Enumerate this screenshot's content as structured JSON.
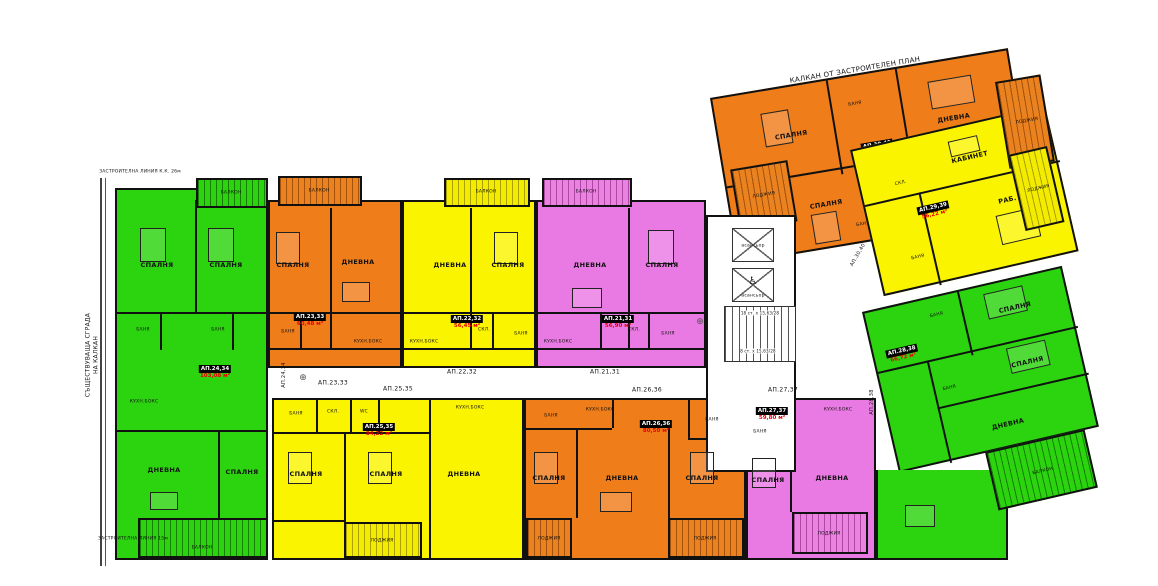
{
  "annotations": {
    "top_boundary": "КАЛКАН ОТ ЗАСТРОИТЕЛЕН ПЛАН",
    "left_boundary_line1": "СЪЩЕСТВУВАЩА СГРАДА",
    "left_boundary_line2": "НА КАЛКАН",
    "top_left_note": "ЗАСТРОИТЕЛНА ЛИНИЯ К.К. 26м",
    "bottom_left_note": "ЗАСТРОИТЕЛНА ЛИНИЯ 15м",
    "axis_mark": "⊕"
  },
  "core": {
    "elevator1": "асансьор",
    "elevator2": "асансьор",
    "wheelchair_icon": "♿",
    "stairs_upper": "18 ст. х 15,63/28",
    "stairs_lower": "8 ст. х 15,63/28"
  },
  "colors": {
    "green": "#2bd40e",
    "orange": "#ef7d1a",
    "yellow": "#fbf400",
    "magenta": "#ea7ae3",
    "area_text": "#e80000"
  },
  "apartments": {
    "ap2131": {
      "id": "АП.21,31",
      "area": "56,90 м²",
      "rooms": {
        "balkon": "БАЛКОН",
        "dnevna": "ДНЕВНА",
        "spalnya": "СПАЛНЯ",
        "banya": "БАНЯ",
        "skl": "СКЛ.",
        "kuhn": "КУХН.БОКС"
      }
    },
    "ap2232": {
      "id": "АП.22,32",
      "area": "56,45 м²",
      "rooms": {
        "balkon": "БАЛКОН",
        "dnevna": "ДНЕВНА",
        "spalnya": "СПАЛНЯ",
        "banya": "БАНЯ",
        "skl": "СКЛ.",
        "kuhn": "КУХН.БОКС"
      }
    },
    "ap2333": {
      "id": "АП.23,33",
      "area": "60,48 м²",
      "rooms": {
        "balkon": "БАЛКОН",
        "spalnya": "СПАЛНЯ",
        "dnevna": "ДНЕВНА",
        "banya": "БАНЯ",
        "kuhn": "КУХН.БОКС"
      }
    },
    "ap2434": {
      "id": "АП.24,34",
      "area": "103,08 м²",
      "rooms": {
        "balkon_top": "БАЛКОН",
        "spalnya1": "СПАЛНЯ",
        "spalnya2": "СПАЛНЯ",
        "banya1": "БАНЯ",
        "banya2": "БАНЯ",
        "kuhn": "КУХН.БОКС",
        "dnevna": "ДНЕВНА",
        "spalnya3": "СПАЛНЯ",
        "balkon_bottom": "БАЛКОН"
      }
    },
    "ap2535": {
      "id": "АП.25,35",
      "area": "84,22 м²",
      "rooms": {
        "banya": "БАНЯ",
        "skl": "СКЛ.",
        "wc": "WC",
        "kuhn": "КУХН.БОКС",
        "spalnya1": "СПАЛНЯ",
        "spalnya2": "СПАЛНЯ",
        "dnevna": "ДНЕВНА",
        "lodzhiya": "ЛОДЖИЯ"
      }
    },
    "ap2636": {
      "id": "АП.26,36",
      "area": "80,50 м²",
      "rooms": {
        "banya1": "БАНЯ",
        "banya2": "БАНЯ",
        "kuhn": "КУХН.БОКС",
        "spalnya1": "СПАЛНЯ",
        "dnevna": "ДНЕВНА",
        "spalnya2": "СПАЛНЯ",
        "lodzhiya1": "ЛОДЖИЯ",
        "lodzhiya2": "ЛОДЖИЯ"
      }
    },
    "ap2737": {
      "id": "АП.27,37",
      "area": "59,80 м²",
      "rooms": {
        "banya": "БАНЯ",
        "kuhn": "КУХН.БОКС",
        "spalnya": "СПАЛНЯ",
        "dnevna": "ДНЕВНА",
        "lodzhiya": "ЛОДЖИЯ"
      }
    },
    "ap2838": {
      "id": "АП.28,38",
      "area": "66,72 м²",
      "rooms": {
        "banya1": "БАНЯ",
        "spalnya1": "СПАЛНЯ",
        "banya2": "БАНЯ",
        "spalnya2": "СПАЛНЯ",
        "dnevna": "ДНЕВНА",
        "balkon": "БАЛКОН"
      }
    },
    "ap2939": {
      "id": "АП.29,39",
      "area": "56,22 м²",
      "rooms": {
        "kabinet": "КАБИНЕТ",
        "rab_pom": "РАБ. ПОМ.",
        "banya": "БАНЯ",
        "skl": "СКЛ.",
        "lodzhiya": "ЛОДЖИЯ"
      }
    },
    "ap3040": {
      "id": "АП.30,40",
      "area": "92,94 м²",
      "rooms": {
        "spalnya1": "СПАЛНЯ",
        "banya1": "БАНЯ",
        "dnevna": "ДНЕВНА",
        "lodzhiya1": "ЛОДЖИЯ",
        "spalnya2": "СПАЛНЯ",
        "skl": "СКЛ.",
        "banya2": "БАНЯ",
        "lodzhiya2": "ЛОДЖИЯ"
      }
    }
  }
}
